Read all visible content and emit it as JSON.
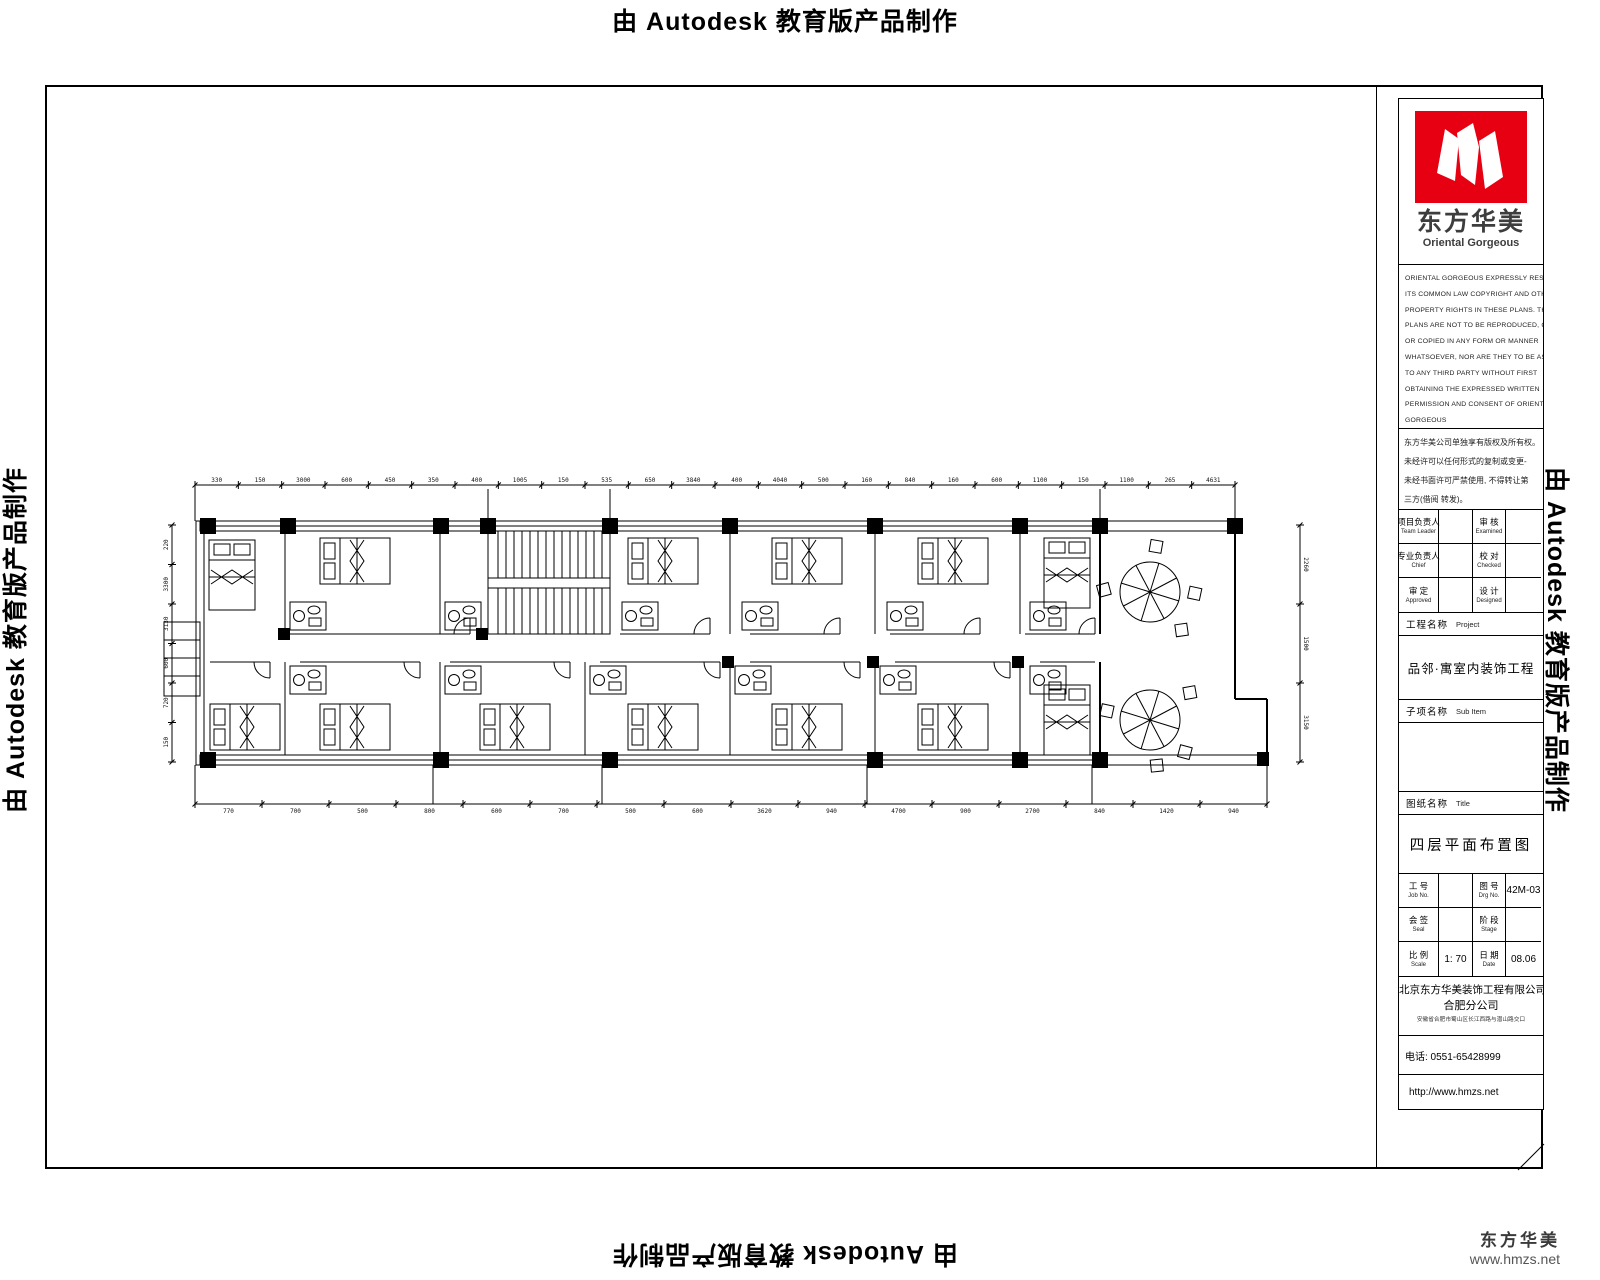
{
  "watermarks": {
    "text": "由 Autodesk 教育版产品制作"
  },
  "title_block": {
    "brand": {
      "cn": "东方华美",
      "en": "Oriental Gorgeous",
      "logo_color": "#e60012"
    },
    "copyright_lines": [
      "ORIENTAL GORGEOUS EXPRESSLY RESERVES",
      "ITS COMMON LAW COPYRIGHT AND OTHER",
      "PROPERTY RIGHTS IN THESE PLANS. THESE",
      "PLANS ARE NOT TO BE REPRODUCED, CHANGED",
      "OR COPIED IN ANY FORM OR MANNER",
      "WHATSOEVER, NOR ARE THEY TO BE ASSIGNED",
      "TO ANY THIRD PARTY WITHOUT FIRST",
      "OBTAINING THE EXPRESSED WRITTEN",
      "PERMISSION AND CONSENT OF ORIENTAL",
      "GORGEOUS"
    ],
    "notice_lines": [
      "东方华美公司单独享有版权及所有权。",
      "未经许可以任何形式的复制或变更-",
      "未经书面许可严禁使用, 不得转让第",
      "三方(借阅 转发)。"
    ],
    "personnel_rows": [
      {
        "c1": {
          "cn": "项目负责人",
          "en": "Team Leader"
        },
        "v1": "",
        "c2": {
          "cn": "审 核",
          "en": "Examined"
        },
        "v2": ""
      },
      {
        "c1": {
          "cn": "专业负责人",
          "en": "Chief"
        },
        "v1": "",
        "c2": {
          "cn": "校 对",
          "en": "Checked"
        },
        "v2": ""
      },
      {
        "c1": {
          "cn": "审 定",
          "en": "Approved"
        },
        "v1": "",
        "c2": {
          "cn": "设 计",
          "en": "Designed"
        },
        "v2": ""
      }
    ],
    "project": {
      "label_cn": "工程名称",
      "label_en": "Project",
      "value": "品邻·寓室内装饰工程"
    },
    "sub_item": {
      "label_cn": "子项名称",
      "label_en": "Sub Item",
      "value": ""
    },
    "sheet": {
      "label_cn": "图纸名称",
      "label_en": "Title",
      "value": "四层平面布置图"
    },
    "info_rows": [
      {
        "c1": {
          "cn": "工 号",
          "en": "Job No."
        },
        "v1": "",
        "c2": {
          "cn": "图 号",
          "en": "Drg No."
        },
        "v2": "42M-03"
      },
      {
        "c1": {
          "cn": "会 签",
          "en": "Seal"
        },
        "v1": "",
        "c2": {
          "cn": "阶 段",
          "en": "Stage"
        },
        "v2": ""
      },
      {
        "c1": {
          "cn": "比 例",
          "en": "Scale"
        },
        "v1": "1: 70",
        "c2": {
          "cn": "日 期",
          "en": "Date"
        },
        "v2": "08.06"
      }
    ],
    "company": {
      "line1": "北京东方华美装饰工程有限公司",
      "line2": "合肥分公司",
      "address": "安徽省合肥市蜀山区长江西路与潜山路交口"
    },
    "phone": "电话: 0551-65428999",
    "url": "http://www.hmzs.net"
  },
  "plan": {
    "dims_top": [
      "330",
      "150",
      "3000",
      "600",
      "450",
      "350",
      "400",
      "1005",
      "150",
      "535",
      "650",
      "3840",
      "400",
      "4040",
      "500",
      "160",
      "840",
      "160",
      "600",
      "1100",
      "150",
      "1100",
      "265",
      "4631"
    ],
    "dims_bottom": [
      "770",
      "700",
      "500",
      "800",
      "600",
      "700",
      "500",
      "600",
      "3620",
      "940",
      "4700",
      "900",
      "2700",
      "840",
      "1420",
      "940"
    ],
    "dims_left": [
      "220",
      "3300",
      "3130",
      "600",
      "720",
      "150"
    ],
    "dims_right": [
      "2260",
      "1500",
      "3150"
    ]
  },
  "footer": {
    "brand": "东方华美",
    "url": "www.hmzs.net"
  }
}
